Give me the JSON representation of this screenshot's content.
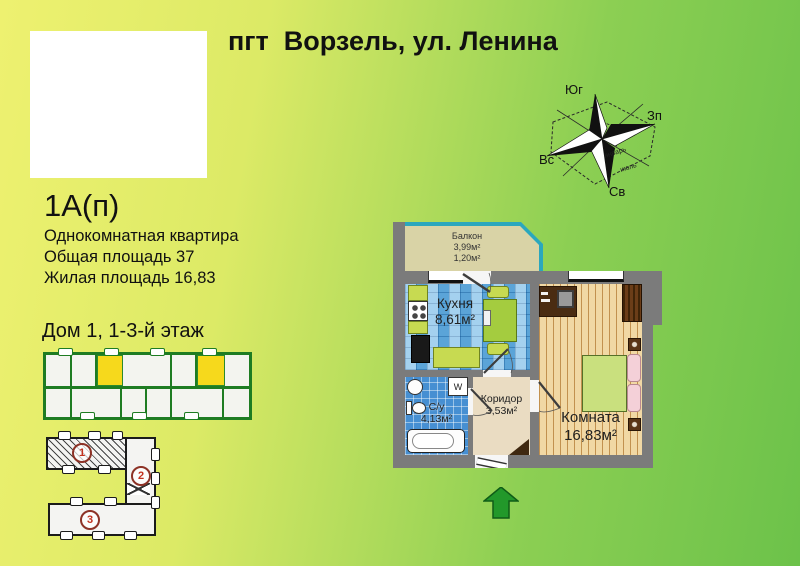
{
  "header": {
    "title": "пгт  Ворзель, ул. Ленина"
  },
  "apartment": {
    "code": "1А(п)",
    "type": "Однокомнатная квартира",
    "total_area": "Общая площадь 37",
    "living_area": "Жилая площадь 16,83",
    "house_floor": "Дом 1, 1-3-й этаж"
  },
  "compass": {
    "top": "Юг",
    "right": "Зп",
    "left": "Вс",
    "bottom": "Св",
    "month_jan": "январь",
    "month_jul": "июль"
  },
  "plan": {
    "balcony": {
      "name": "Балкон",
      "area1": "3,99м²",
      "area2": "1,20м²"
    },
    "kitchen": {
      "name": "Кухня",
      "area": "8,61м²"
    },
    "bathroom": {
      "name": "С/у",
      "area": "4,13м²"
    },
    "corridor": {
      "name": "Коридор",
      "area": "3,53м²"
    },
    "room": {
      "name": "Комната",
      "area": "16,83м²"
    },
    "washer_label": "W"
  },
  "site_plan": {
    "block_numbers": [
      "1",
      "2",
      "3"
    ]
  },
  "colors": {
    "bg_left": "#eef170",
    "bg_right": "#6cc24a",
    "wall_gray": "#7b7b7b",
    "kitchen_tile": "#74b9e6",
    "bath_tile": "#468fd2",
    "wood_floor": "#f1d8a4",
    "corridor_floor": "#eadcc2",
    "balcony_glazing": "#2ba7bd",
    "highlight_yellow": "#f6d91c",
    "arrow_green": "#22982a",
    "number_red": "#c2321f"
  }
}
